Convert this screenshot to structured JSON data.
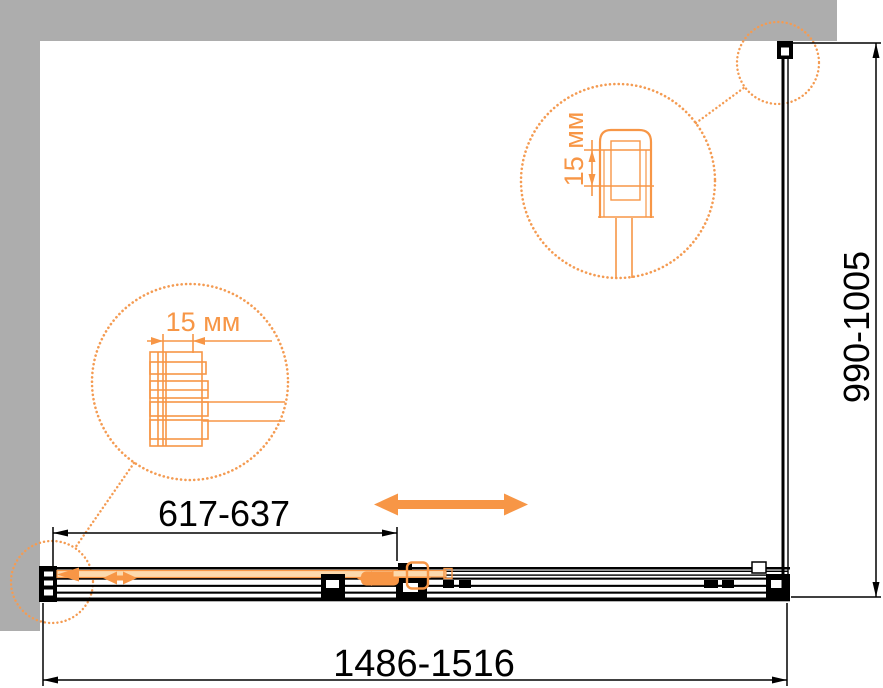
{
  "dimensions": {
    "door_range": "617-637",
    "overall_width_range": "1486-1516",
    "depth_range": "990-1005"
  },
  "details": {
    "left_zoom_label": "15 мм",
    "right_zoom_label": "15 мм"
  },
  "colors": {
    "accent_orange": "#F79646",
    "accent_orange_light": "#FCD9AD",
    "dotted_orange": "#F49B52",
    "line_black": "#000000",
    "frame_gray": "#ADADAD",
    "canvas_white": "#FFFFFF"
  }
}
